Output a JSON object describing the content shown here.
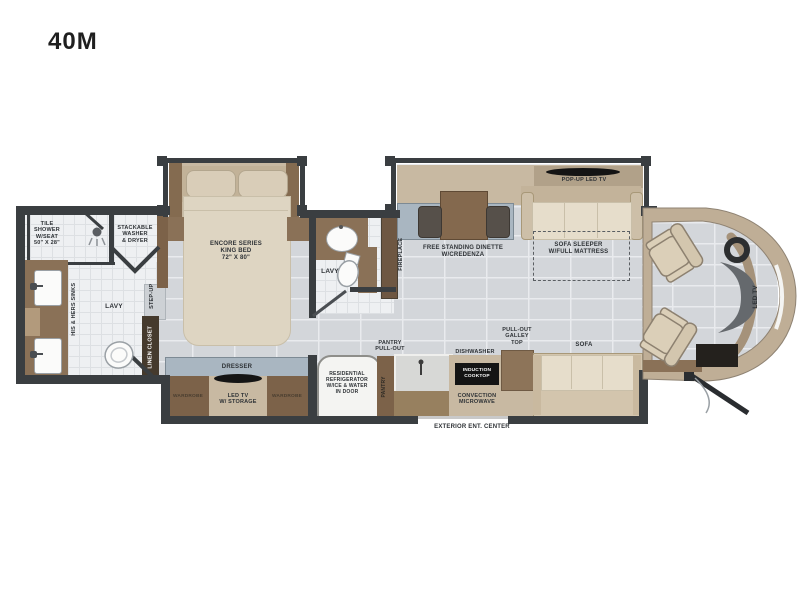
{
  "model": "40M",
  "labels": {
    "tile_shower": "TILE\nSHOWER\nW/SEAT\n50\" X 28\"",
    "washer_dryer": "STACKABLE\nWASHER\n& DRYER",
    "his_hers_sinks": "HIS & HERS SINKS",
    "lavy_rear": "LAVY",
    "step_up": "STEP-UP",
    "linen_closet": "LINEN CLOSET",
    "king_bed": "ENCORE SERIES\nKING BED\n72\" X 80\"",
    "lavy_mid": "LAVY",
    "fireplace": "FIREPLACE",
    "dinette": "FREE STANDING DINETTE\nW/CREDENZA",
    "popup_tv": "POP-UP LED TV",
    "sofa_sleeper": "SOFA SLEEPER\nW/FULL MATTRESS",
    "dresser": "DRESSER",
    "wardrobe_left": "WARDROBE",
    "led_tv_storage": "LED TV\nW/ STORAGE",
    "wardrobe_right": "WARDROBE",
    "refrigerator": "RESIDENTIAL\nREFRIGERATOR\nW/ICE & WATER\nIN DOOR",
    "pantry": "PANTRY",
    "pantry_pullout": "PANTRY\nPULL-OUT",
    "dishwasher": "DISHWASHER",
    "induction_cooktop": "INDUCTION\nCOOKTOP",
    "convection_microwave": "CONVECTION\nMICROWAVE",
    "pullout_galley_top": "PULL-OUT\nGALLEY\nTOP",
    "sofa": "SOFA",
    "exterior_ent_center": "EXTERIOR ENT. CENTER",
    "led_tv_front": "LED TV"
  },
  "colors": {
    "wall": "#3a3e41",
    "wood": "#8a7157",
    "wood_dark": "#7c6249",
    "tan": "#c8b9a2",
    "cream": "#e6ddcb",
    "counter_blue": "#a9b6c1",
    "floor": "#d3d6da",
    "bath_floor": "#eef0f2",
    "cap_band": "#bfae96",
    "appliance_black": "#141414"
  }
}
